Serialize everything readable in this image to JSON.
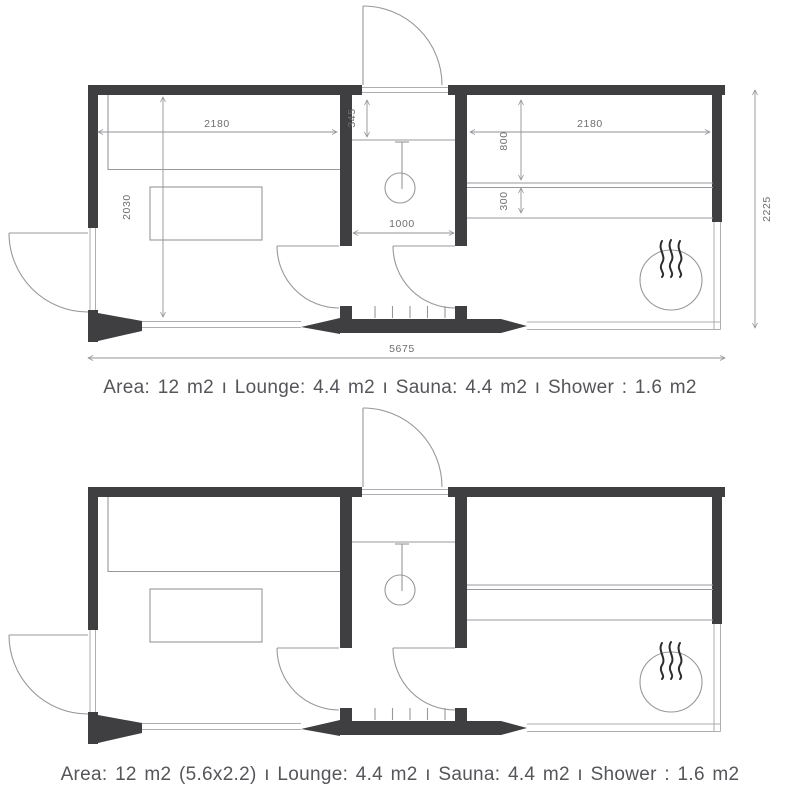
{
  "captions": {
    "top": "Area: 12 m2 ı Lounge: 4.4 m2 ı Sauna: 4.4 m2 ı Shower : 1.6 m2",
    "bottom": "Area: 12 m2 (5.6x2.2) ı Lounge: 4.4 m2 ı Sauna: 4.4 m2 ı Shower : 1.6 m2"
  },
  "dimensions_mm": {
    "lounge_width": "2180",
    "lounge_depth": "2030",
    "shower_shelf_depth": "345",
    "shower_width": "1000",
    "sauna_width": "2180",
    "sauna_bench_depth": "800",
    "sauna_bench_step": "300",
    "overall_depth": "2225",
    "overall_width": "5675"
  },
  "icons": {
    "sauna_heater": "circle-with-heat-waves",
    "shower_head": "circle-with-hose-line",
    "floor_grate": "tick-marks",
    "door_swing": "quarter-arc"
  },
  "colors": {
    "wall": "#3f3f41",
    "line": "#98989c",
    "glass": "#aeaeb2",
    "dim": "#939397",
    "dim_text": "#6e6e72",
    "caption_text": "#55565a",
    "heater_stroke": "#2d2d2f"
  }
}
